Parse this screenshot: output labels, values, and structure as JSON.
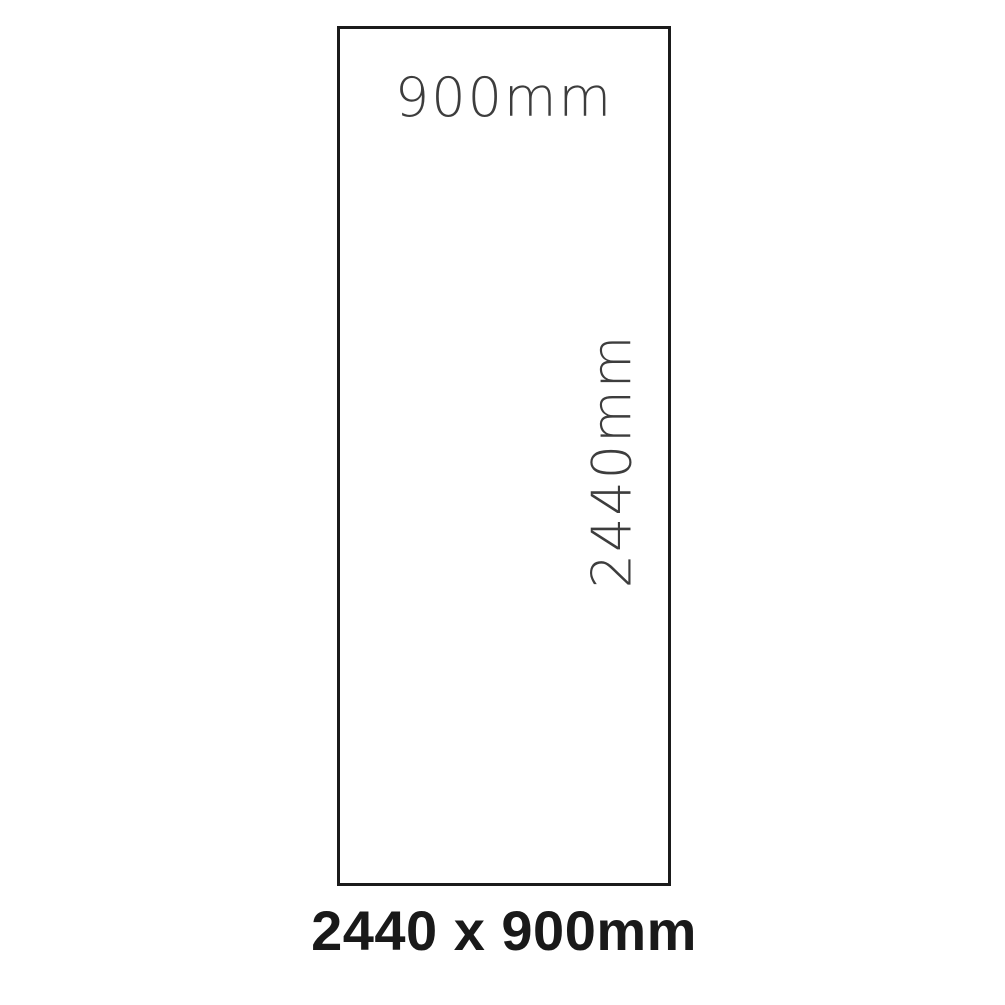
{
  "diagram": {
    "type": "dimension-drawing",
    "shape": "rectangle",
    "width_label": "900mm",
    "height_label": "2440mm",
    "caption": "2440 x 900mm",
    "dimensions": {
      "width_mm": 900,
      "height_mm": 2440
    },
    "colors": {
      "background": "#ffffff",
      "outline": "#1b1b1b",
      "dimension_text": "#3d3d3d",
      "caption_text": "#191919"
    }
  }
}
